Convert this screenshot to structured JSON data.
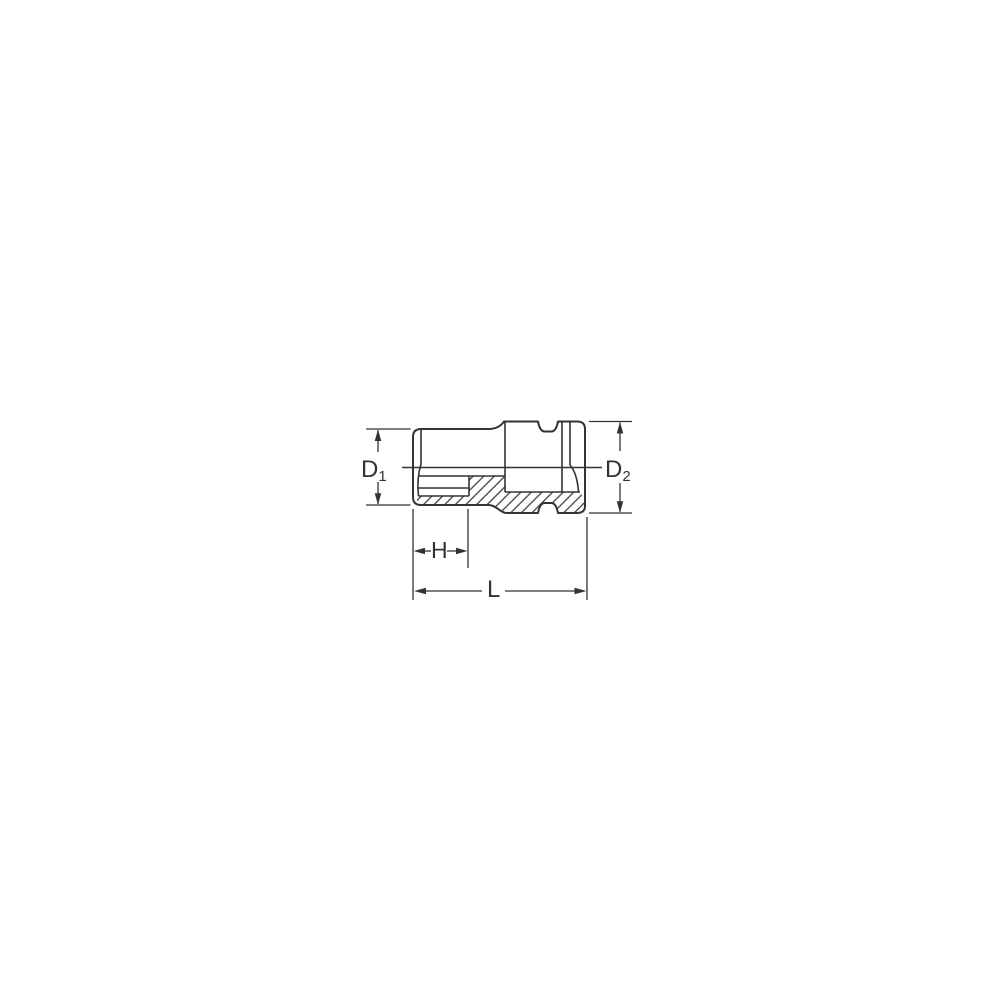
{
  "diagram": {
    "kind": "socket-cross-section-dimension-drawing",
    "line_color": "#333333",
    "background_color": "#ffffff",
    "labels": {
      "d1": {
        "base": "D",
        "sub": "1"
      },
      "d2": {
        "base": "D",
        "sub": "2"
      },
      "h": "H",
      "l": "L"
    }
  }
}
